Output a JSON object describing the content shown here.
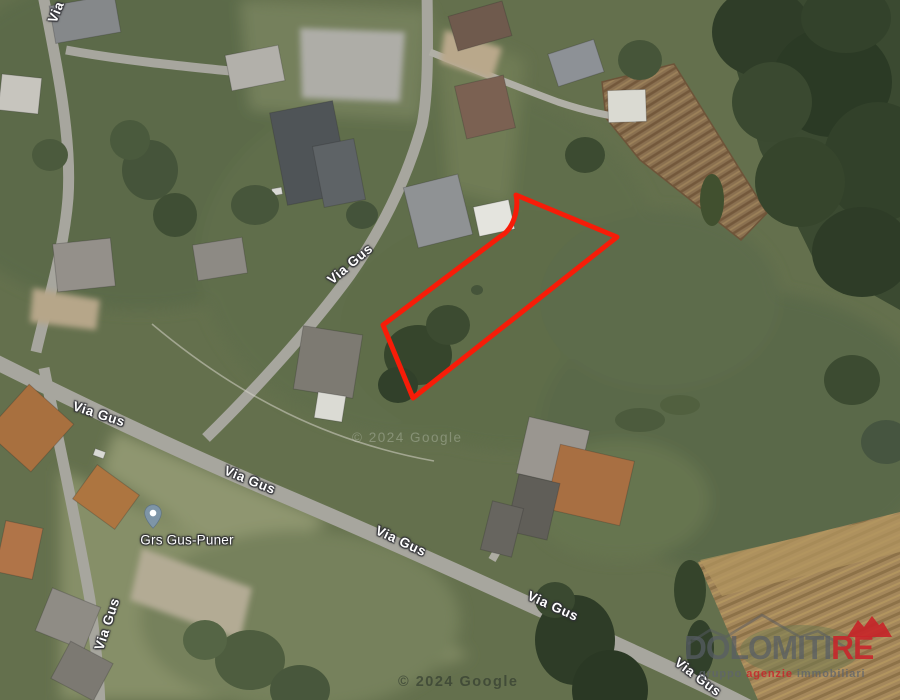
{
  "map": {
    "street_labels": [
      {
        "text": "Via Gus",
        "x": 350,
        "y": 264,
        "rotation": -40
      },
      {
        "text": "Via Gus",
        "x": 99,
        "y": 414,
        "rotation": 18
      },
      {
        "text": "Via Gus",
        "x": 250,
        "y": 480,
        "rotation": 22
      },
      {
        "text": "Via Gus",
        "x": 401,
        "y": 541,
        "rotation": 25
      },
      {
        "text": "Via Gus",
        "x": 553,
        "y": 606,
        "rotation": 24
      },
      {
        "text": "Via Gus",
        "x": 698,
        "y": 677,
        "rotation": 37
      },
      {
        "text": "Via Gus",
        "x": 107,
        "y": 624,
        "rotation": -72
      },
      {
        "text": "Via Gus",
        "x": 62,
        "y": -3,
        "rotation": -68
      }
    ],
    "marker": {
      "label": "Grs Gus-Puner",
      "pin_color": "#7e95a7"
    },
    "copyright_center": "© 2024 Google",
    "copyright_bottom": "© 2024 Google",
    "parcel_color": "#f71c08"
  },
  "watermark": {
    "brand_main": "DOLOMITI",
    "brand_suffix": "RE",
    "brand_gray": "#585d65",
    "brand_red": "#c8262b",
    "tagline": {
      "part1": "gruppo",
      "part2": "agenzie",
      "part3": "immobiliari"
    }
  }
}
